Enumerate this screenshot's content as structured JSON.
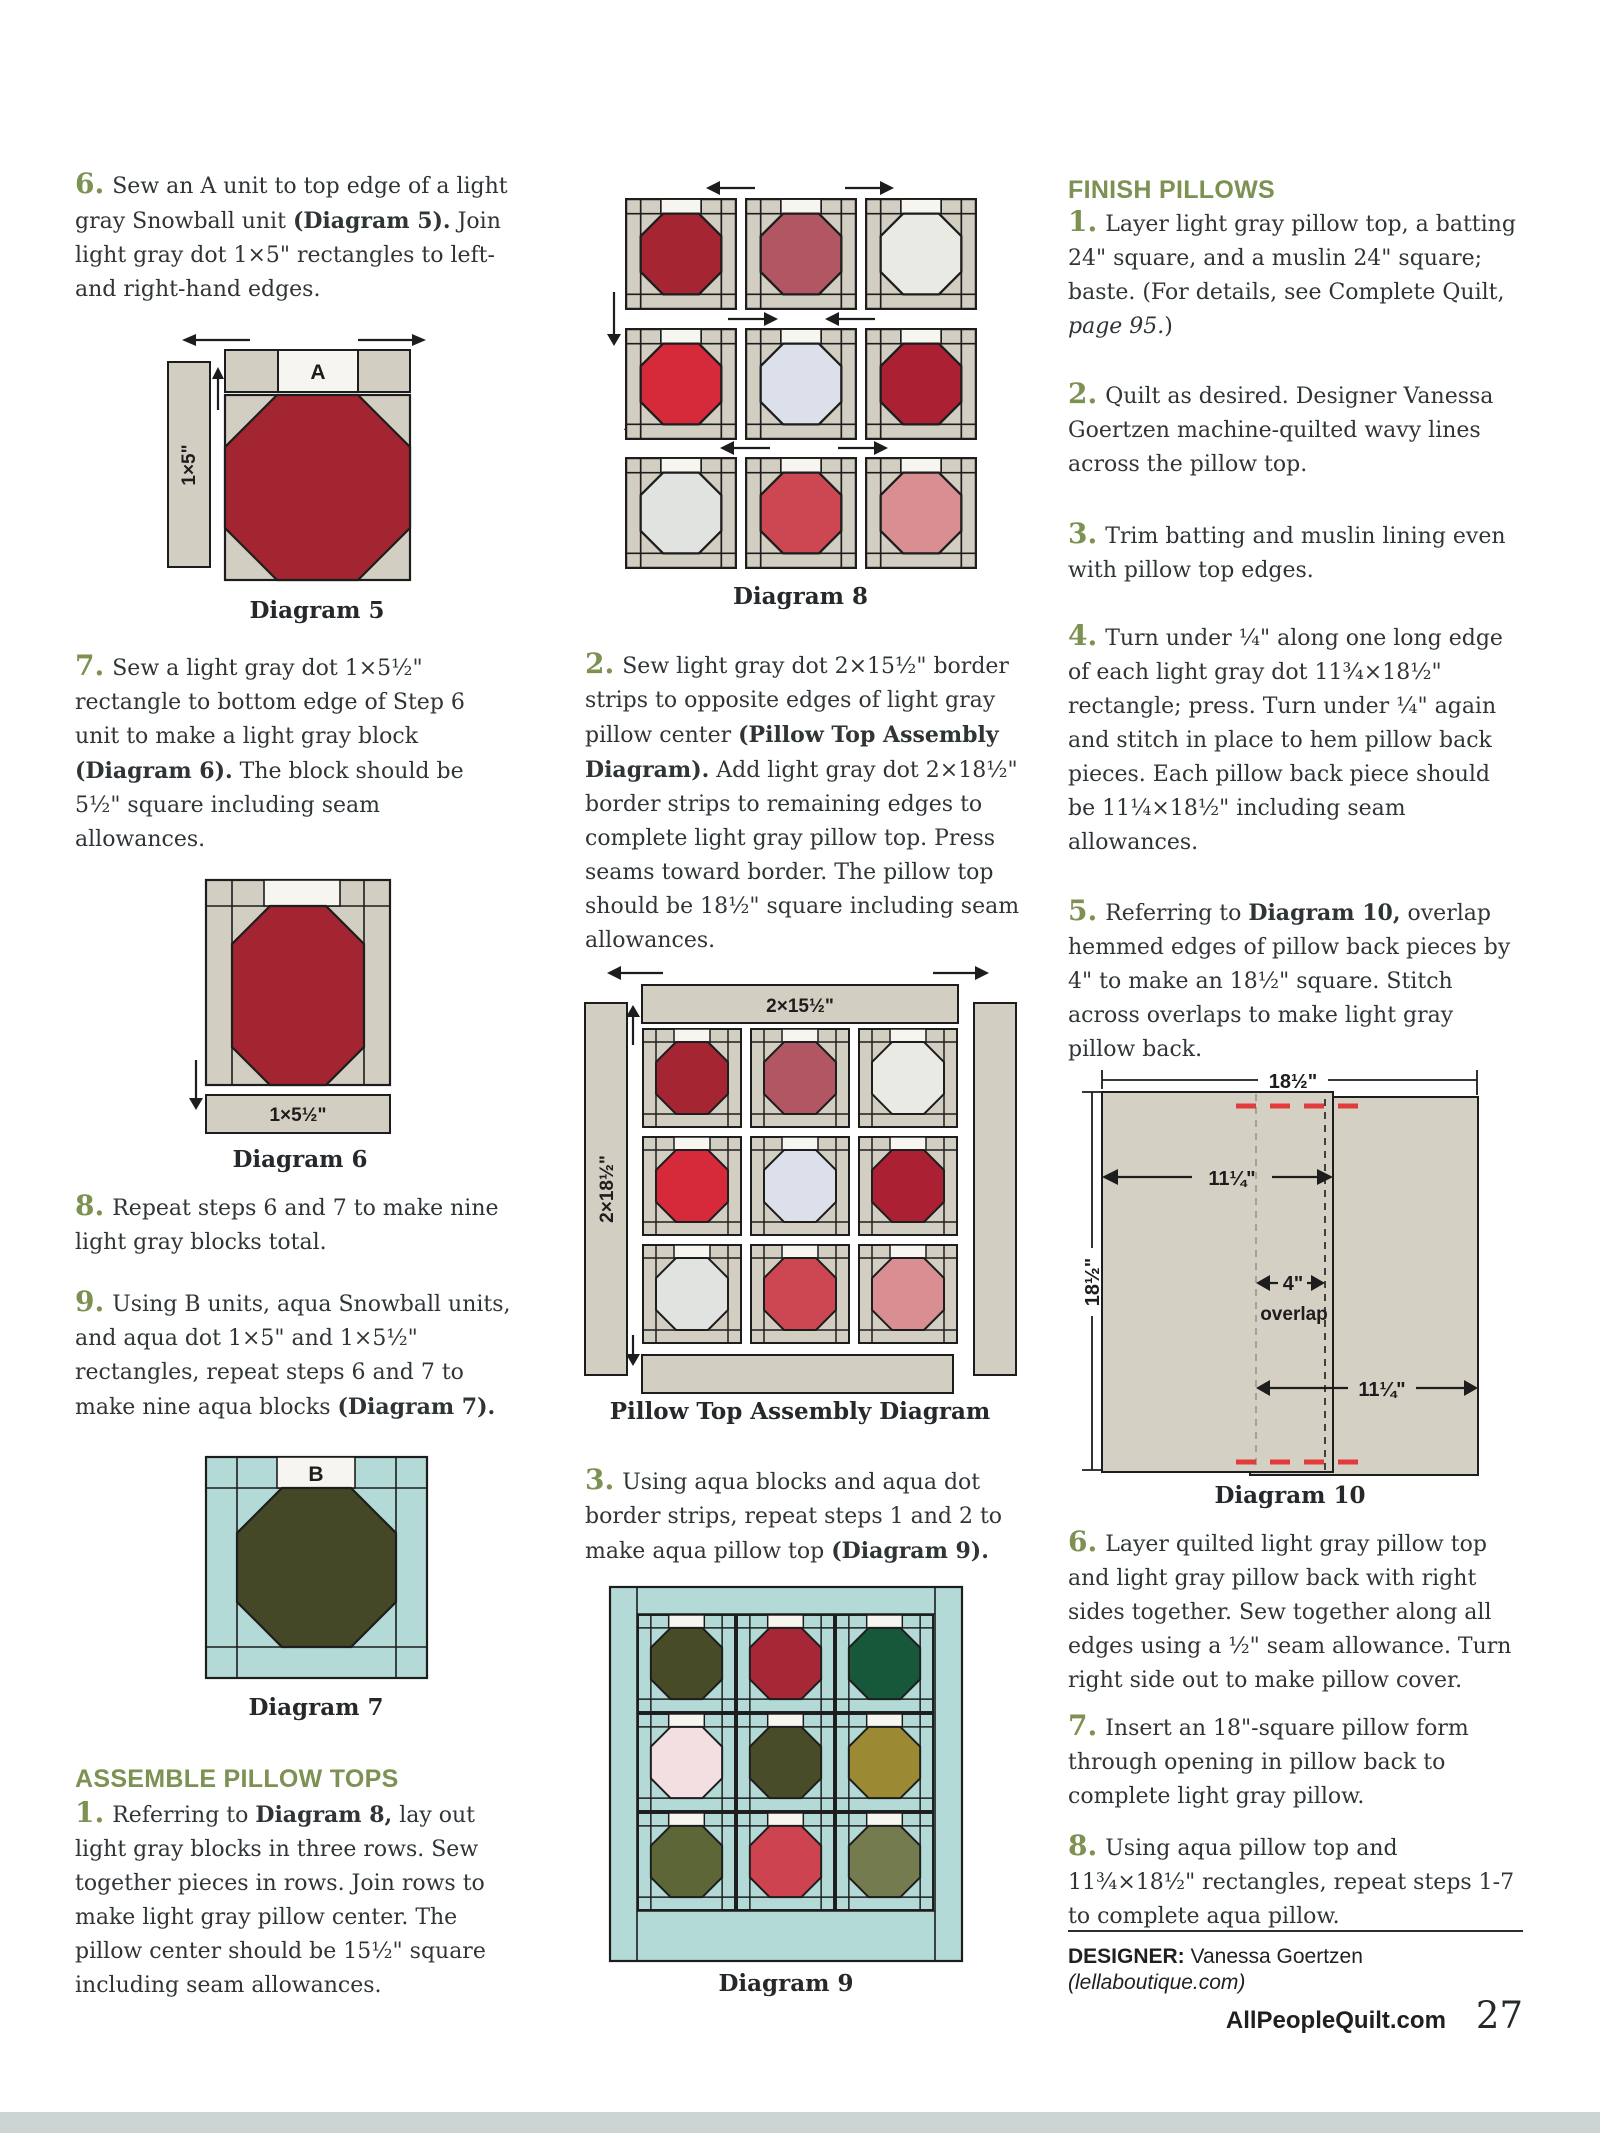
{
  "palette": {
    "green": "#7c9152",
    "ink": "#2f3437",
    "fabric_gray": "#d3cec2",
    "fabric_white": "#f7f5f0",
    "fabric_aqua": "#b4dad7",
    "outline": "#1d1d1d",
    "red_dash": "#e23b3c"
  },
  "left": {
    "step6": {
      "num": "6.",
      "segments": [
        {
          "t": "Sew an A unit to top edge of a light gray Snowball unit "
        },
        {
          "t": "(Diagram 5).",
          "b": true
        },
        {
          "t": " Join light gray dot 1×5\" rectangles to left- and right-hand edges."
        }
      ]
    },
    "step7": {
      "num": "7.",
      "segments": [
        {
          "t": "Sew a light gray dot 1×5½\" rectangle to bottom edge of Step 6 unit to make a light gray block "
        },
        {
          "t": "(Diagram 6).",
          "b": true
        },
        {
          "t": " The block should be 5½\" square including seam allowances."
        }
      ]
    },
    "step8": {
      "num": "8.",
      "segments": [
        {
          "t": "Repeat steps 6 and 7 to make nine light gray blocks total."
        }
      ]
    },
    "step9": {
      "num": "9.",
      "segments": [
        {
          "t": "Using B units, aqua Snowball units, and aqua dot 1×5\" and 1×5½\" rectangles, repeat steps 6 and 7 to make nine aqua blocks "
        },
        {
          "t": "(Diagram 7).",
          "b": true
        }
      ]
    },
    "assemble_heading": "ASSEMBLE PILLOW TOPS",
    "ap1": {
      "num": "1.",
      "segments": [
        {
          "t": "Referring to "
        },
        {
          "t": "Diagram 8,",
          "b": true
        },
        {
          "t": " lay out light gray blocks in three rows. Sew together pieces in rows. Join rows to make light gray pillow center. The pillow center should be 15½\" square including seam allowances."
        }
      ]
    }
  },
  "middle": {
    "step2": {
      "num": "2.",
      "segments": [
        {
          "t": "Sew light gray dot 2×15½\" border strips to opposite edges of light gray pillow center "
        },
        {
          "t": "(Pillow Top Assembly Diagram).",
          "b": true
        },
        {
          "t": " Add light gray dot 2×18½\" border strips to remaining edges to complete light gray pillow top. Press seams toward border. The pillow top should be 18½\" square including seam allowances."
        }
      ]
    },
    "step3": {
      "num": "3.",
      "segments": [
        {
          "t": "Using aqua blocks and aqua dot border strips, repeat steps 1 and 2 to make aqua pillow top "
        },
        {
          "t": "(Diagram 9).",
          "b": true
        }
      ]
    }
  },
  "right": {
    "finish_heading": "FINISH PILLOWS",
    "f1": {
      "num": "1.",
      "segments": [
        {
          "t": "Layer light gray pillow top, a batting 24\" square, and a muslin 24\" square; baste. (For details, see Complete Quilt, "
        },
        {
          "t": "page 95.",
          "i": true
        },
        {
          "t": ")"
        }
      ]
    },
    "f2": {
      "num": "2.",
      "segments": [
        {
          "t": "Quilt as desired. Designer Vanessa Goertzen machine-quilted wavy lines across the pillow top."
        }
      ]
    },
    "f3": {
      "num": "3.",
      "segments": [
        {
          "t": "Trim batting and muslin lining even with pillow top edges."
        }
      ]
    },
    "f4": {
      "num": "4.",
      "segments": [
        {
          "t": "Turn under ¼\" along one long edge of each light gray dot 11¾×18½\" rectangle; press. Turn under ¼\" again and stitch in place to hem pillow back pieces. Each pillow back piece should be 11¼×18½\" including seam allowances."
        }
      ]
    },
    "f5": {
      "num": "5.",
      "segments": [
        {
          "t": "Referring to "
        },
        {
          "t": "Diagram 10,",
          "b": true
        },
        {
          "t": " overlap hemmed edges of pillow back pieces by 4\" to make an 18½\" square. Stitch across overlaps to make light gray pillow back."
        }
      ]
    },
    "f6": {
      "num": "6.",
      "segments": [
        {
          "t": "Layer quilted light gray pillow top and light gray pillow back with right sides together. Sew together along all edges using a ½\" seam allowance. Turn right side out to make pillow cover."
        }
      ]
    },
    "f7": {
      "num": "7.",
      "segments": [
        {
          "t": "Insert an 18\"-square pillow form through opening in pillow back to complete light gray pillow."
        }
      ]
    },
    "f8": {
      "num": "8.",
      "segments": [
        {
          "t": "Using aqua pillow top and 11¾×18½\" rectangles, repeat steps 1-7 to complete aqua pillow."
        }
      ]
    }
  },
  "diagram5": {
    "caption": "Diagram 5",
    "label_a": "A",
    "label_side": "1×5\"",
    "octagon": "#a32532"
  },
  "diagram6": {
    "caption": "Diagram 6",
    "label_bottom": "1×5½\"",
    "octagon": "#a32532"
  },
  "diagram7": {
    "caption": "Diagram 7",
    "label_b": "B",
    "octagon": "#454827"
  },
  "diagram8": {
    "caption": "Diagram 8",
    "octagons": [
      "#a62532",
      "#b25663",
      "#e9eae4",
      "#d62939",
      "#dbe0ea",
      "#ab2133",
      "#e1e3e0",
      "#cd4753",
      "#d98f92"
    ]
  },
  "pillow_top_assembly": {
    "caption": "Pillow Top Assembly Diagram",
    "label_top": "2×15½\"",
    "label_left": "2×18½\"",
    "octagons": [
      "#a62532",
      "#b25663",
      "#e9eae4",
      "#d62939",
      "#dbe0ea",
      "#ab2133",
      "#e1e3e0",
      "#cd4753",
      "#d98f92"
    ]
  },
  "diagram9": {
    "caption": "Diagram 9",
    "octagons": [
      "#474b26",
      "#a62836",
      "#17573a",
      "#f3dee2",
      "#484c28",
      "#9b8a33",
      "#5c6636",
      "#cd4450",
      "#747c4f"
    ]
  },
  "diagram10": {
    "caption": "Diagram 10",
    "dim_top": "18½\"",
    "dim_left": "18½\"",
    "dim_piece_left": "11¼\"",
    "dim_overlap": "4\"",
    "overlap_label": "overlap",
    "dim_piece_right": "11¼\""
  },
  "footer": {
    "designer_label": "DESIGNER:",
    "designer_name": "Vanessa Goertzen",
    "designer_site": "(lellaboutique.com)",
    "site": "AllPeopleQuilt.com",
    "page_number": "27"
  }
}
